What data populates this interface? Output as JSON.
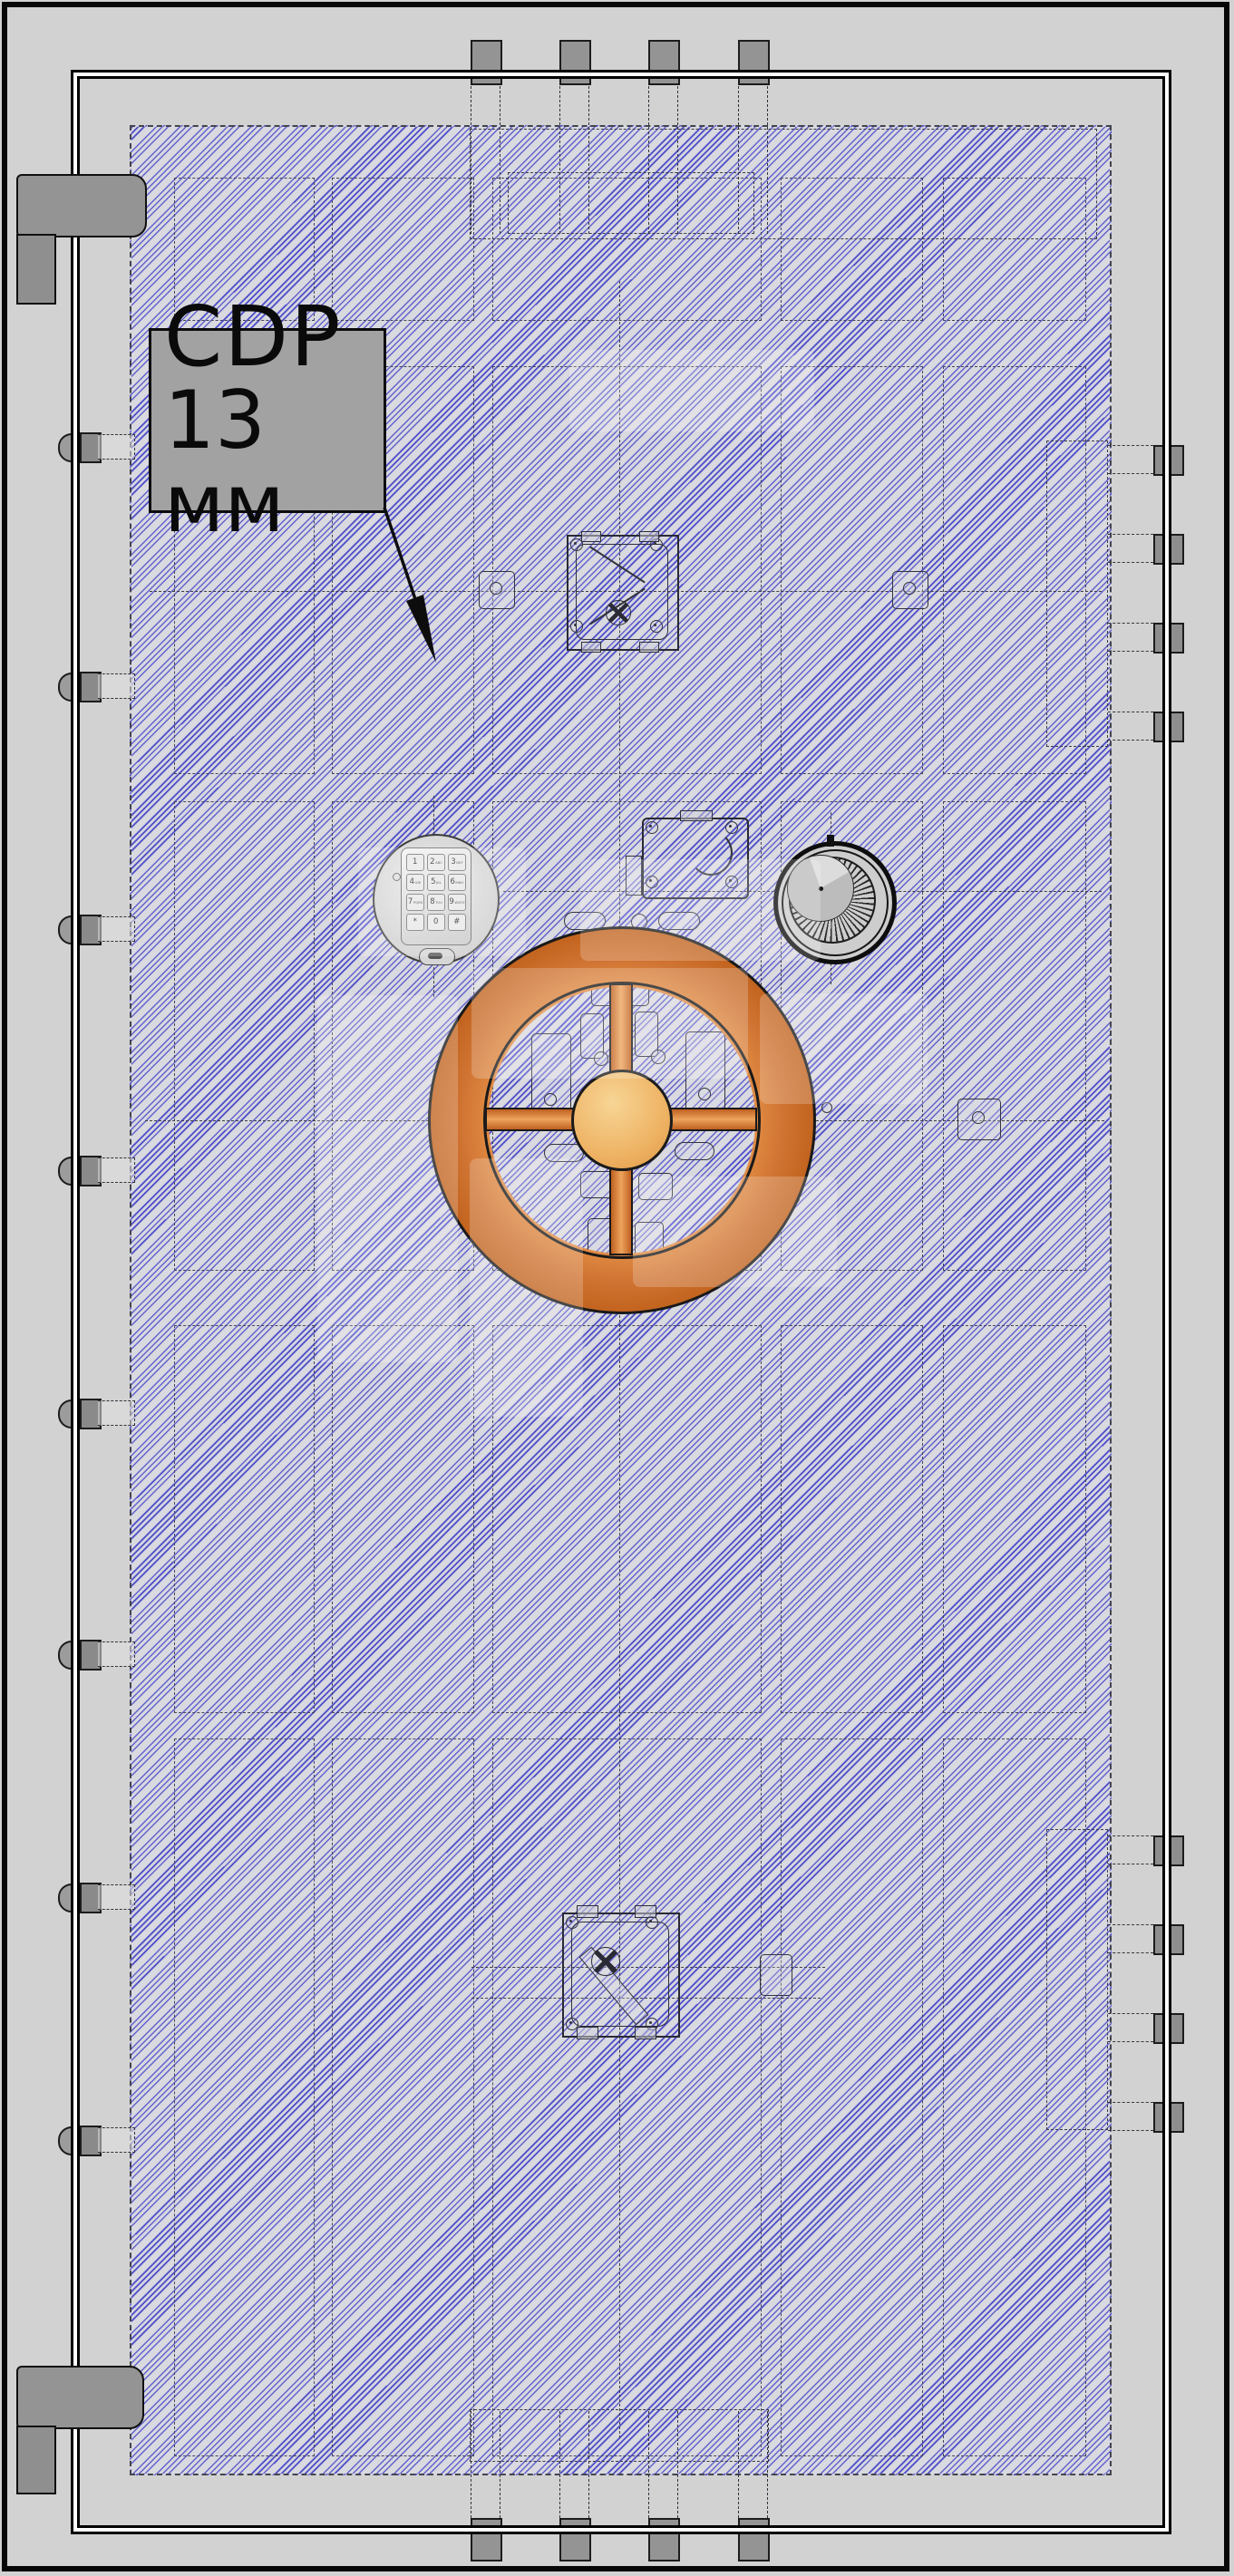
{
  "drawing": {
    "callout": {
      "line1": "CDP",
      "line2": "13 мм"
    },
    "keypad_keys": [
      {
        "d": "1",
        "s": ""
      },
      {
        "d": "2",
        "s": "ABC"
      },
      {
        "d": "3",
        "s": "DEF"
      },
      {
        "d": "4",
        "s": "GHI"
      },
      {
        "d": "5",
        "s": "JKL"
      },
      {
        "d": "6",
        "s": "MNO"
      },
      {
        "d": "7",
        "s": "PQRS"
      },
      {
        "d": "8",
        "s": "TUV"
      },
      {
        "d": "9",
        "s": "WXYZ"
      },
      {
        "d": "*",
        "s": ""
      },
      {
        "d": "0",
        "s": ""
      },
      {
        "d": "#",
        "s": ""
      }
    ],
    "colors": {
      "hatch_blue": "#3737c6",
      "panel_gray": "#d9d9e0",
      "wheel_orange": "#cf7330",
      "wheel_hub": "#eeb263",
      "callout_bg": "#a2a2a2",
      "metal_gray": "#929292",
      "line_dark": "#1a1a1a",
      "background": "#d2d2d2"
    }
  }
}
